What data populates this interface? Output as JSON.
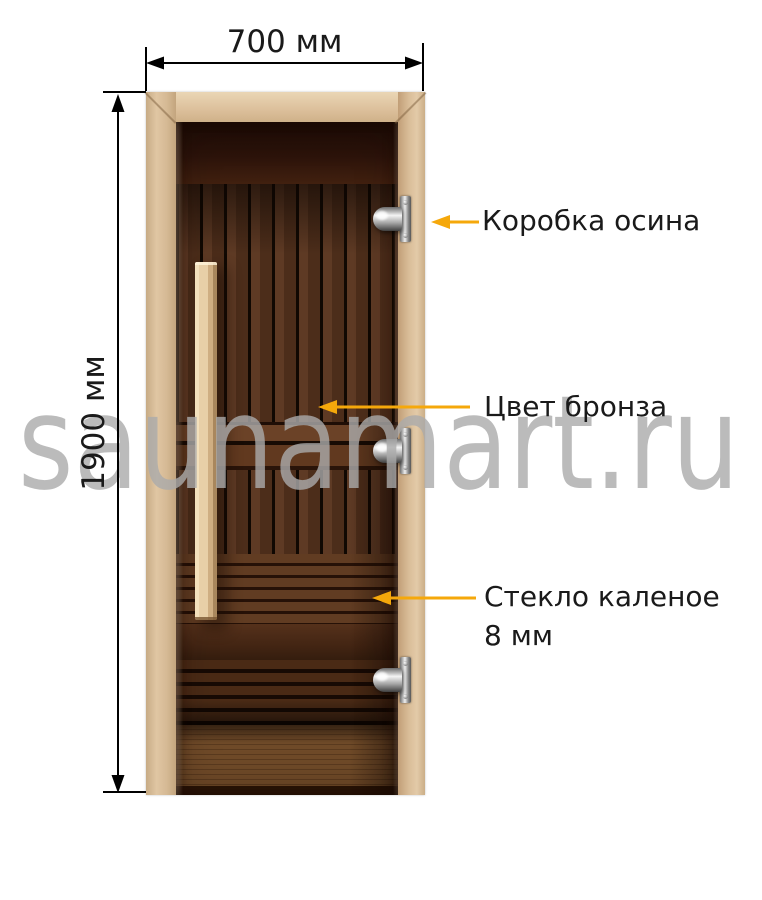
{
  "image_type": "sauna-door-dimension-diagram",
  "watermark": {
    "text": "saunamart.ru"
  },
  "dimensions": {
    "width_label": "700 мм",
    "height_label": "1900 мм"
  },
  "callouts": [
    {
      "target": "door-frame-hinge",
      "label": "Коробка осина"
    },
    {
      "target": "glass-tint",
      "label": "Цвет бронза"
    },
    {
      "target": "glass-pane",
      "label": "Стекло каленое",
      "label2": "8 мм"
    }
  ],
  "door": {
    "hinge_count": 3,
    "parts": [
      "frame",
      "bronze-glass",
      "wooden-handle",
      "hinges"
    ]
  },
  "colors": {
    "background": "#ffffff",
    "arrow": "#f5a80b",
    "dimension": "#000000",
    "text": "#1a1a1a",
    "watermark": "#ababab",
    "frame_wood": "#d7bc9a",
    "handle_wood": "#ead2ab",
    "glass_dark": "#3a1d10"
  }
}
